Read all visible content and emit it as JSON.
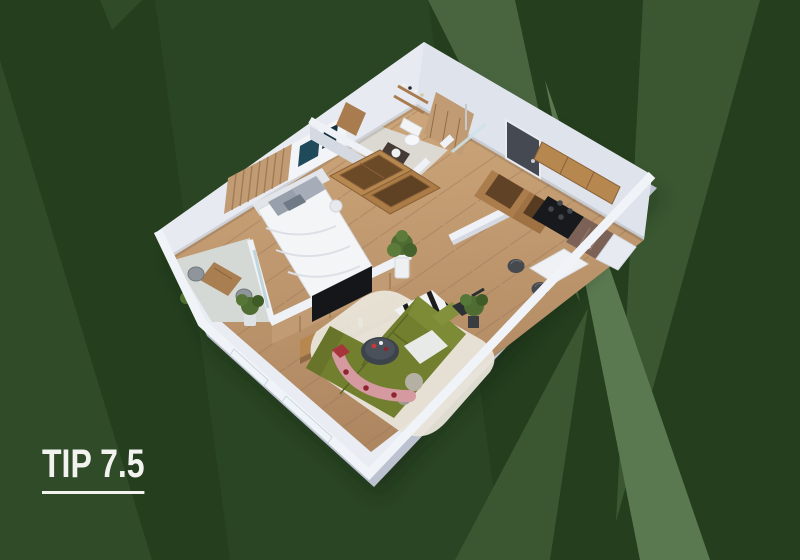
{
  "title": {
    "text": "TIP 7.5"
  },
  "background": {
    "base": "#243e1e",
    "stripe_subtle": "#2a4523",
    "stripe_wedge": "#2f4b28",
    "stripe_medium": "#3a5731",
    "stripe_upper_left": "#496540",
    "stripe_bright": "#5b7951"
  },
  "palette": {
    "wall_top": "#e9ecf2",
    "wall_outer": "#bcc2cf",
    "wall_face_nw": "#e7eaf0",
    "wall_face_ne": "#dfe3eb",
    "floor_balcony": "#d5d9d5",
    "floor_bath": "#dcd8d2",
    "wood_furniture": "#b6884f",
    "wood_slats": "#c09b73",
    "sofa_olive": "#727f2e",
    "rug_cream": "#e9e5da",
    "rug_pink": "#d59aa0",
    "table_dark": "#3d434b",
    "tv_black": "#14161a",
    "door_dark": "#454a52",
    "stove_black": "#17191d",
    "counter_marble": "#7c6157",
    "plant_green": "#4f6c33",
    "bed_white": "#f4f5f7"
  },
  "floorplan": {
    "label": "apartment-3d-floorplan",
    "rooms": [
      "balcony",
      "bedroom",
      "bathroom",
      "entry",
      "kitchen",
      "living-room"
    ]
  }
}
